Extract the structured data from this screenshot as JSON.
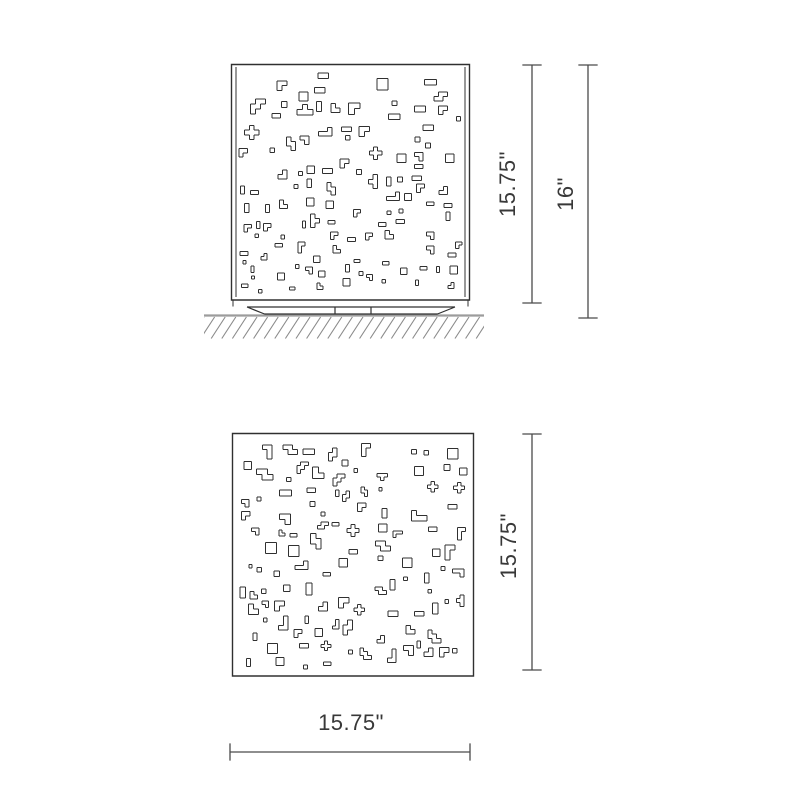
{
  "drawing": {
    "colors": {
      "background": "#ffffff",
      "line": "#303030",
      "dim": "#4a4a4a",
      "text": "#383838",
      "ground": "#9c9c9c",
      "hatch": "#8a8a8a"
    },
    "dimensions": {
      "front_panel_height": "15.75\"",
      "front_overall_height": "16\"",
      "plan_depth": "15.75\"",
      "plan_width": "15.75\""
    },
    "pattern": {
      "front": {
        "seed": 1337,
        "count": 114
      },
      "plan": {
        "seed": 4242,
        "count": 112
      },
      "cell_min": 3.2,
      "cell_max": 5.4
    }
  }
}
